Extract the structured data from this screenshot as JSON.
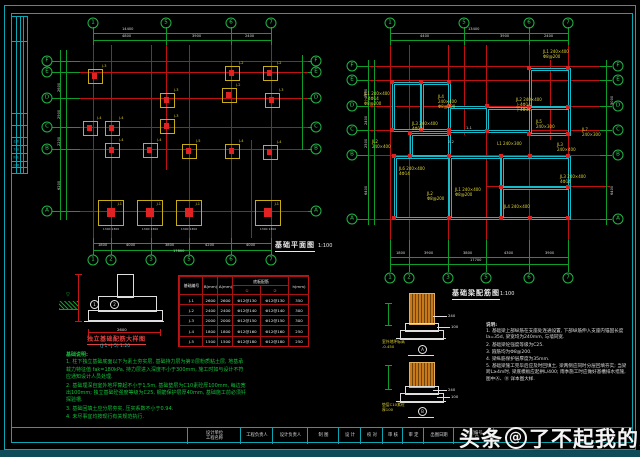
{
  "watermark": {
    "brand": "头条",
    "at": "@",
    "account": "了不起我的家"
  },
  "left_plan": {
    "title": "基础平面图",
    "scale": "1:100",
    "title_pos": [
      275,
      240
    ],
    "scale_pos": [
      318,
      243
    ],
    "red_v": [
      [
        93,
        45,
        238
      ],
      [
        111,
        45,
        238
      ],
      [
        151,
        45,
        238
      ],
      [
        166,
        45,
        170
      ],
      [
        189,
        45,
        238
      ],
      [
        231,
        45,
        238
      ],
      [
        251,
        140,
        238
      ],
      [
        271,
        45,
        238
      ]
    ],
    "red_h": [
      [
        61,
        80,
        312
      ],
      [
        72,
        80,
        312
      ],
      [
        98,
        80,
        312
      ],
      [
        127,
        80,
        312
      ],
      [
        149,
        80,
        312
      ],
      [
        211,
        80,
        312
      ]
    ],
    "green_h": [
      [
        33,
        93,
        271
      ],
      [
        40,
        93,
        271
      ],
      [
        243,
        93,
        271
      ],
      [
        250,
        93,
        271
      ],
      [
        61,
        52,
        80
      ],
      [
        72,
        52,
        80
      ],
      [
        98,
        52,
        80
      ],
      [
        127,
        52,
        80
      ],
      [
        149,
        52,
        80
      ],
      [
        211,
        52,
        80
      ],
      [
        61,
        308,
        312
      ],
      [
        72,
        308,
        312
      ],
      [
        98,
        308,
        312
      ],
      [
        127,
        308,
        312
      ],
      [
        149,
        308,
        312
      ],
      [
        211,
        308,
        312
      ]
    ],
    "green_v": [
      [
        60,
        50,
        220
      ],
      [
        66,
        50,
        220
      ],
      [
        93,
        27,
        45
      ],
      [
        166,
        27,
        45
      ],
      [
        231,
        27,
        45
      ],
      [
        271,
        27,
        45
      ],
      [
        93,
        238,
        255
      ],
      [
        111,
        238,
        255
      ],
      [
        151,
        238,
        255
      ],
      [
        189,
        238,
        255
      ],
      [
        231,
        238,
        255
      ],
      [
        271,
        238,
        255
      ],
      [
        302,
        55,
        150
      ]
    ],
    "bubbles": [
      [
        93,
        23,
        "1"
      ],
      [
        166,
        23,
        "5"
      ],
      [
        231,
        23,
        "6"
      ],
      [
        271,
        23,
        "7"
      ],
      [
        93,
        260,
        "1"
      ],
      [
        111,
        260,
        "2"
      ],
      [
        151,
        260,
        "3"
      ],
      [
        189,
        260,
        "5"
      ],
      [
        231,
        260,
        "6"
      ],
      [
        271,
        260,
        "7"
      ],
      [
        47,
        61,
        "F"
      ],
      [
        47,
        72,
        "E"
      ],
      [
        47,
        98,
        "D"
      ],
      [
        47,
        127,
        "C"
      ],
      [
        47,
        149,
        "B"
      ],
      [
        47,
        211,
        "A"
      ],
      [
        316,
        61,
        "F"
      ],
      [
        316,
        72,
        "E"
      ],
      [
        316,
        98,
        "D"
      ],
      [
        316,
        127,
        "C"
      ],
      [
        316,
        149,
        "B"
      ],
      [
        316,
        211,
        "A"
      ]
    ],
    "footings": [
      [
        94,
        75,
        13,
        "J-3"
      ],
      [
        231,
        72,
        13,
        "J-2"
      ],
      [
        269,
        72,
        13,
        "J-2"
      ],
      [
        166,
        99,
        13,
        "J-3"
      ],
      [
        228,
        94,
        13,
        "J-2"
      ],
      [
        271,
        99,
        13,
        "J-3"
      ],
      [
        89,
        127,
        13,
        "J-4"
      ],
      [
        111,
        127,
        13,
        "J-4"
      ],
      [
        166,
        125,
        13,
        "J-3"
      ],
      [
        111,
        149,
        13,
        "J-4"
      ],
      [
        149,
        149,
        13,
        "J-4"
      ],
      [
        188,
        150,
        13,
        "J-5"
      ],
      [
        231,
        150,
        13,
        "J-4"
      ],
      [
        269,
        151,
        13,
        "J-4"
      ],
      [
        110,
        212,
        24,
        "J-1"
      ],
      [
        149,
        212,
        24,
        "J-1"
      ],
      [
        188,
        212,
        24,
        "J-1"
      ],
      [
        267,
        212,
        24,
        "J-1"
      ]
    ],
    "dims": [
      [
        122,
        27,
        "14400"
      ],
      [
        122,
        34,
        "4800"
      ],
      [
        192,
        34,
        "3900"
      ],
      [
        245,
        34,
        "2400"
      ],
      [
        98,
        243,
        "1800"
      ],
      [
        126,
        243,
        "4000"
      ],
      [
        165,
        243,
        "3800"
      ],
      [
        205,
        243,
        "4200"
      ],
      [
        246,
        243,
        "4000"
      ],
      [
        173,
        249,
        "17800"
      ],
      [
        57,
        92,
        "2600",
        -90
      ],
      [
        57,
        119,
        "2900",
        -90
      ],
      [
        57,
        146,
        "2200",
        -90
      ],
      [
        57,
        190,
        "6200",
        -90
      ]
    ]
  },
  "right_plan": {
    "title": "基础梁配筋图",
    "scale": "1:100",
    "title_pos": [
      452,
      288
    ],
    "scale_pos": [
      500,
      291
    ],
    "red_v": [
      [
        390,
        45,
        250
      ],
      [
        409,
        45,
        250
      ],
      [
        448,
        45,
        250
      ],
      [
        464,
        45,
        135
      ],
      [
        486,
        45,
        250
      ],
      [
        529,
        45,
        250
      ],
      [
        550,
        60,
        140
      ],
      [
        568,
        45,
        250
      ]
    ],
    "red_h": [
      [
        66,
        362,
        610
      ],
      [
        80,
        362,
        610
      ],
      [
        106,
        362,
        610
      ],
      [
        130,
        362,
        610
      ],
      [
        155,
        362,
        610
      ],
      [
        219,
        362,
        610
      ],
      [
        186,
        486,
        610
      ]
    ],
    "green_h": [
      [
        33,
        390,
        568
      ],
      [
        40,
        390,
        568
      ],
      [
        257,
        390,
        568
      ],
      [
        264,
        390,
        568
      ],
      [
        66,
        357,
        368
      ],
      [
        80,
        357,
        368
      ],
      [
        106,
        357,
        368
      ],
      [
        130,
        357,
        368
      ],
      [
        155,
        357,
        368
      ],
      [
        219,
        357,
        368
      ],
      [
        66,
        600,
        612
      ],
      [
        80,
        600,
        612
      ],
      [
        106,
        600,
        612
      ],
      [
        130,
        600,
        612
      ],
      [
        155,
        600,
        612
      ],
      [
        219,
        600,
        612
      ]
    ],
    "green_v": [
      [
        368,
        60,
        225
      ],
      [
        374,
        60,
        225
      ],
      [
        606,
        60,
        225
      ],
      [
        390,
        27,
        45
      ],
      [
        464,
        27,
        45
      ],
      [
        529,
        27,
        45
      ],
      [
        568,
        27,
        45
      ],
      [
        390,
        240,
        272
      ],
      [
        409,
        240,
        272
      ],
      [
        448,
        240,
        272
      ],
      [
        486,
        240,
        272
      ],
      [
        529,
        240,
        272
      ],
      [
        568,
        240,
        272
      ]
    ],
    "bubbles": [
      [
        390,
        23,
        "1"
      ],
      [
        464,
        23,
        "5"
      ],
      [
        529,
        23,
        "6"
      ],
      [
        568,
        23,
        "7"
      ],
      [
        390,
        278,
        "1"
      ],
      [
        409,
        278,
        "2"
      ],
      [
        448,
        278,
        "3"
      ],
      [
        486,
        278,
        "5"
      ],
      [
        529,
        278,
        "6"
      ],
      [
        568,
        278,
        "7"
      ],
      [
        352,
        66,
        "F"
      ],
      [
        352,
        80,
        "E"
      ],
      [
        352,
        106,
        "D"
      ],
      [
        352,
        130,
        "C"
      ],
      [
        352,
        155,
        "B"
      ],
      [
        352,
        219,
        "A"
      ],
      [
        618,
        66,
        "F"
      ],
      [
        618,
        80,
        "E"
      ],
      [
        618,
        106,
        "D"
      ],
      [
        618,
        130,
        "C"
      ],
      [
        618,
        155,
        "B"
      ],
      [
        618,
        219,
        "A"
      ]
    ],
    "rooms": [
      [
        392,
        82,
        29,
        48
      ],
      [
        421,
        82,
        28,
        48
      ],
      [
        448,
        106,
        39,
        25
      ],
      [
        486,
        107,
        44,
        24
      ],
      [
        529,
        68,
        40,
        39
      ],
      [
        529,
        107,
        40,
        27
      ],
      [
        410,
        133,
        39,
        23
      ],
      [
        394,
        156,
        55,
        62
      ],
      [
        449,
        156,
        52,
        62
      ],
      [
        501,
        156,
        68,
        31
      ],
      [
        501,
        187,
        68,
        31
      ]
    ],
    "dots": [
      [
        392,
        82
      ],
      [
        421,
        82
      ],
      [
        449,
        82
      ],
      [
        392,
        130
      ],
      [
        421,
        130
      ],
      [
        449,
        130
      ],
      [
        449,
        106
      ],
      [
        487,
        106
      ],
      [
        487,
        131
      ],
      [
        529,
        68
      ],
      [
        568,
        68
      ],
      [
        529,
        107
      ],
      [
        568,
        107
      ],
      [
        529,
        134
      ],
      [
        568,
        134
      ],
      [
        410,
        133
      ],
      [
        449,
        133
      ],
      [
        410,
        156
      ],
      [
        394,
        156
      ],
      [
        449,
        156
      ],
      [
        501,
        156
      ],
      [
        530,
        156
      ],
      [
        568,
        156
      ],
      [
        394,
        218
      ],
      [
        449,
        218
      ],
      [
        501,
        218
      ],
      [
        530,
        218
      ],
      [
        568,
        218
      ],
      [
        501,
        187
      ],
      [
        568,
        187
      ]
    ],
    "anns": [
      [
        364,
        92,
        [
          "JL1 240×400",
          "上4Φ14",
          "Φ8@200"
        ]
      ],
      [
        372,
        140,
        [
          "JL2",
          "240×400"
        ]
      ],
      [
        412,
        122,
        [
          "JL3 240×400",
          "4Φ14"
        ]
      ],
      [
        438,
        95,
        [
          "JL4",
          "240×400",
          "Φ8@200"
        ]
      ],
      [
        455,
        188,
        [
          "JL1 240×400",
          "Φ8@200"
        ]
      ],
      [
        516,
        98,
        [
          "JL2 240×400",
          "上4Φ14",
          "下4Φ14"
        ]
      ],
      [
        543,
        50,
        [
          "JL1 240×400",
          "Φ8@200"
        ]
      ],
      [
        536,
        120,
        [
          "JL5",
          "240×300"
        ]
      ],
      [
        557,
        143,
        [
          "JL3",
          "240×400"
        ]
      ],
      [
        399,
        167,
        [
          "JL6 240×400",
          "4Φ14"
        ]
      ],
      [
        427,
        192,
        [
          "JL2",
          "Φ8@200"
        ]
      ],
      [
        497,
        142,
        [
          "L1 240×300"
        ]
      ],
      [
        504,
        205,
        [
          "JL4 240×400"
        ]
      ],
      [
        560,
        175,
        [
          "JL3 240×400",
          "4Φ14"
        ]
      ],
      [
        582,
        128,
        [
          "JL7",
          "240×300"
        ]
      ]
    ],
    "dims": [
      [
        468,
        27,
        "13400"
      ],
      [
        420,
        34,
        "4400"
      ],
      [
        500,
        34,
        "3900"
      ],
      [
        544,
        34,
        "2400"
      ],
      [
        396,
        251,
        "1800"
      ],
      [
        424,
        251,
        "3900"
      ],
      [
        463,
        251,
        "3800"
      ],
      [
        504,
        251,
        "4300"
      ],
      [
        545,
        251,
        "3900"
      ],
      [
        470,
        258,
        "17700"
      ],
      [
        364,
        98,
        "2600",
        -90
      ],
      [
        364,
        125,
        "2400",
        -90
      ],
      [
        364,
        148,
        "2500",
        -90
      ],
      [
        364,
        195,
        "6400",
        -90
      ],
      [
        610,
        105,
        "5000",
        -90
      ],
      [
        610,
        195,
        "6400",
        -90
      ],
      [
        466,
        126,
        "1-1"
      ],
      [
        448,
        140,
        "2-2"
      ]
    ]
  },
  "table": {
    "col_headers": [
      "基础编号",
      "B(mm)",
      "A(mm)",
      "h(mm)"
    ],
    "span_header": "底板配筋",
    "sub_headers": [
      "①",
      "②"
    ],
    "rows": [
      [
        "J-1",
        "2600",
        "2600",
        "Φ12@130",
        "Φ12@130",
        "350"
      ],
      [
        "J-2",
        "2400",
        "2400",
        "Φ12@140",
        "Φ12@140",
        "300"
      ],
      [
        "J-3",
        "2000",
        "2000",
        "Φ12@150",
        "Φ12@150",
        "300"
      ],
      [
        "J-4",
        "1800",
        "1800",
        "Φ12@160",
        "Φ12@160",
        "250"
      ],
      [
        "J-5",
        "1500",
        "1500",
        "Φ12@180",
        "Φ12@180",
        "250"
      ]
    ]
  },
  "detail_left": {
    "title": "独立基础配筋大样图",
    "subtitle": "(J-1~J-5)  1:20",
    "callout1": "1",
    "callout2": "2",
    "dim_bottom": "2600",
    "ground_mark": "▽"
  },
  "detail_a": {
    "label": "A",
    "dim1": "240",
    "dim2": "100",
    "note1": "室外地坪标高",
    "note2": "-0.450"
  },
  "detail_b": {
    "label": "B",
    "dim1": "240",
    "dim2": "100",
    "note1": "垫层C10素砼",
    "note2": "厚100"
  },
  "notes_left": {
    "title": "基础说明:",
    "items": [
      "1. 柱下独立基础底面以下为素土夯实层, 基础持力层为第②层粉质粘土层, 地基承载力特征值 fak=180kPa, 持力层进入深度不小于300mm, 施工时如与设计不符应通知设计人员处理.",
      "2. 基础埋深自室外地坪算起不小于1.5m, 基础垫层为C10素砼厚100mm, 每边宽出100mm; 独立基础砼强度等级为C25, 钢筋保护层厚40mm, 基础施工前必须钎探验槽.",
      "3. 基础回填土应分层夯实, 压实系数不小于0.94.",
      "4. 未尽事宜均按现行有关规范执行."
    ]
  },
  "notes_right": {
    "title": "说明:",
    "items": [
      "1. 基础梁上部纵筋在支座处连通设置, 下部纵筋伸入支座内锚固长度 la=35d, 梁宽均为240mm, 与墙同宽.",
      "2. 基础梁砼强度等级为C25.",
      "3. 箍筋均为Φ8@200.",
      "4. 梁纵筋保护层厚度为35mm.",
      "5. 基础梁施工完毕后应及时回填土, 梁两侧应同时分层回填夯实; 当梁跨L≥4m时, 梁底模板应起拱L/400; 雨季施工时应做好基槽排水措施, 图中Ⓐ、Ⓑ 详本图大样."
    ]
  },
  "titleblock": {
    "cells": [
      {
        "x": 187,
        "w": 53,
        "lines": [
          "设计单位",
          "工程名称"
        ]
      },
      {
        "x": 240,
        "w": 32,
        "lines": [
          "工程负责人"
        ]
      },
      {
        "x": 272,
        "w": 35,
        "lines": [
          "设计负责人"
        ]
      },
      {
        "x": 307,
        "w": 31,
        "lines": [
          "制 图"
        ]
      },
      {
        "x": 338,
        "w": 22,
        "lines": [
          "设 计"
        ]
      },
      {
        "x": 360,
        "w": 22,
        "lines": [
          "校 对"
        ]
      },
      {
        "x": 382,
        "w": 20,
        "lines": [
          "审 核"
        ]
      },
      {
        "x": 402,
        "w": 21,
        "lines": [
          "审 定"
        ]
      },
      {
        "x": 423,
        "w": 30,
        "lines": [
          "出图日期"
        ]
      },
      {
        "x": 453,
        "w": 40,
        "lines": [
          "工程编号",
          "页  日"
        ]
      },
      {
        "x": 493,
        "w": 128,
        "lines": [
          ""
        ]
      }
    ]
  },
  "side_strip": {
    "rows": [
      "会 签",
      "专 业",
      "姓 名",
      "日 期"
    ]
  }
}
